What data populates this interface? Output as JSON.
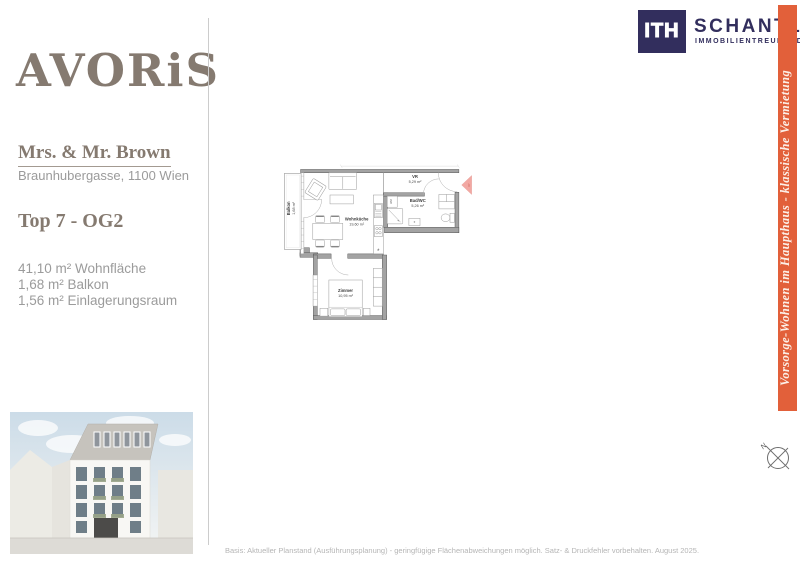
{
  "header": {
    "ith_logo": {
      "letters": "ITH",
      "name": "SCHANTL",
      "subtitle": "IMMOBILIENTREUHAND",
      "navy": "#322e5d"
    }
  },
  "sidebar": {
    "brand": "AVORiS",
    "brand_color": "#857a70",
    "client": "Mrs. & Mr. Brown",
    "address": "Braunhubergasse, 1100 Wien",
    "unit": "Top 7 - OG2",
    "areas": [
      "41,10 m² Wohnfläche",
      "1,68 m² Balkon",
      "1,56 m² Einlagerungsraum"
    ]
  },
  "floorplan": {
    "rooms": [
      {
        "name": "Balkon",
        "area": "1,68 m²"
      },
      {
        "name": "Wohnküche",
        "area": "19,60 m²"
      },
      {
        "name": "VR",
        "area": "5,29 m²"
      },
      {
        "name": "Bad/WC",
        "area": "5,26 m²"
      },
      {
        "name": "Zimmer",
        "area": "10,95 m²"
      }
    ],
    "labels": {
      "washing_machine": "WM",
      "vent": "*",
      "entry": "07"
    },
    "arrow_color": "#f2a8a3"
  },
  "banner": {
    "text": "Vorsorge-Wohnen im Haupthaus - klassische Vermietung",
    "color": "#e2603a"
  },
  "compass": {
    "north": "N"
  },
  "footer": {
    "disclaimer": "Basis: Aktueller Planstand (Ausführungsplanung) - geringfügige Flächenabweichungen möglich. Satz- & Druckfehler vorbehalten. August 2025."
  }
}
